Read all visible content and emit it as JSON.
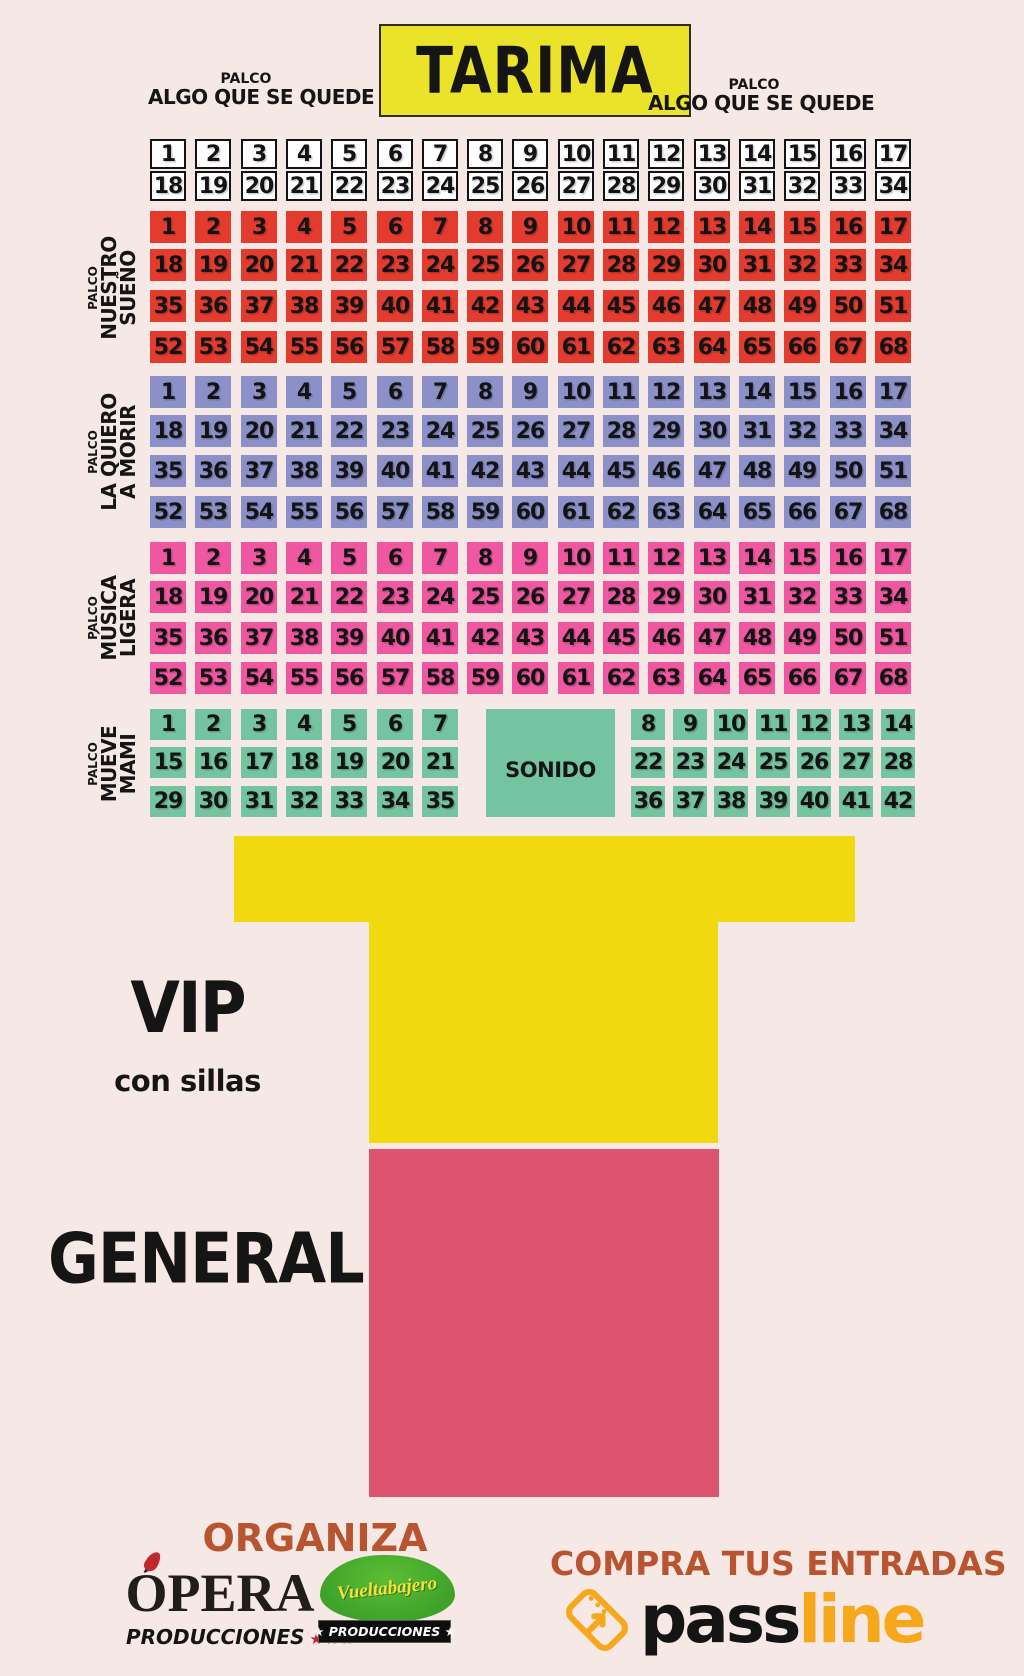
{
  "colors": {
    "background": "#f6e8e4",
    "stage_yellow": "#ebe32a",
    "seat_red": "#e33b2e",
    "seat_purple": "#8b90c8",
    "seat_pink": "#ef57a0",
    "seat_green": "#74c4a1",
    "vip_yellow": "#f0d90e",
    "general_pink": "#dd5470",
    "accent_orange": "#b95430",
    "passline_yellow": "#f6a71b",
    "star_red": "#c1272d",
    "vb_green": "#3fa32a",
    "vb_yellow": "#f3e13c"
  },
  "stage": {
    "label": "TARIMA"
  },
  "top_palco": {
    "left": {
      "small": "PALCO",
      "name": "ALGO QUE SE QUEDE"
    },
    "right": {
      "small": "PALCO",
      "name": "ALGO QUE SE QUEDE"
    }
  },
  "sections": [
    {
      "id": "algo-que-se-quede",
      "style": "white",
      "side_label": null,
      "rows": [
        [
          1,
          2,
          3,
          4,
          5,
          6,
          7,
          8,
          9,
          10,
          11,
          12,
          13,
          14,
          15,
          16,
          17
        ],
        [
          18,
          19,
          20,
          21,
          22,
          23,
          24,
          25,
          26,
          27,
          28,
          29,
          30,
          31,
          32,
          33,
          34
        ]
      ]
    },
    {
      "id": "nuestro-sueno",
      "style": "red",
      "side_label": {
        "small": "PALCO",
        "lines": [
          "NUESTRO",
          "SUEÑO"
        ]
      },
      "rows": [
        [
          1,
          2,
          3,
          4,
          5,
          6,
          7,
          8,
          9,
          10,
          11,
          12,
          13,
          14,
          15,
          16,
          17
        ],
        [
          18,
          19,
          20,
          21,
          22,
          23,
          24,
          25,
          26,
          27,
          28,
          29,
          30,
          31,
          32,
          33,
          34
        ],
        [
          35,
          36,
          37,
          38,
          39,
          40,
          41,
          42,
          43,
          44,
          45,
          46,
          47,
          48,
          49,
          50,
          51
        ],
        [
          52,
          53,
          54,
          55,
          56,
          57,
          58,
          59,
          60,
          61,
          62,
          63,
          64,
          65,
          66,
          67,
          68
        ]
      ]
    },
    {
      "id": "la-quiero-a-morir",
      "style": "purple",
      "side_label": {
        "small": "PALCO",
        "lines": [
          "LA QUIERO",
          "A MORIR"
        ]
      },
      "rows": [
        [
          1,
          2,
          3,
          4,
          5,
          6,
          7,
          8,
          9,
          10,
          11,
          12,
          13,
          14,
          15,
          16,
          17
        ],
        [
          18,
          19,
          20,
          21,
          22,
          23,
          24,
          25,
          26,
          27,
          28,
          29,
          30,
          31,
          32,
          33,
          34
        ],
        [
          35,
          36,
          37,
          38,
          39,
          40,
          41,
          42,
          43,
          44,
          45,
          46,
          47,
          48,
          49,
          50,
          51
        ],
        [
          52,
          53,
          54,
          55,
          56,
          57,
          58,
          59,
          60,
          61,
          62,
          63,
          64,
          65,
          66,
          67,
          68
        ]
      ]
    },
    {
      "id": "musica-ligera",
      "style": "pink",
      "side_label": {
        "small": "PALCO",
        "lines": [
          "MÚSICA",
          "LIGERA"
        ]
      },
      "rows": [
        [
          1,
          2,
          3,
          4,
          5,
          6,
          7,
          8,
          9,
          10,
          11,
          12,
          13,
          14,
          15,
          16,
          17
        ],
        [
          18,
          19,
          20,
          21,
          22,
          23,
          24,
          25,
          26,
          27,
          28,
          29,
          30,
          31,
          32,
          33,
          34
        ],
        [
          35,
          36,
          37,
          38,
          39,
          40,
          41,
          42,
          43,
          44,
          45,
          46,
          47,
          48,
          49,
          50,
          51
        ],
        [
          52,
          53,
          54,
          55,
          56,
          57,
          58,
          59,
          60,
          61,
          62,
          63,
          64,
          65,
          66,
          67,
          68
        ]
      ]
    },
    {
      "id": "mueve-mami",
      "style": "green",
      "side_label": {
        "small": "PALCO",
        "lines": [
          "MUEVE",
          "MAMI"
        ]
      },
      "rows": [
        {
          "left": [
            1,
            2,
            3,
            4,
            5,
            6,
            7
          ],
          "right": [
            8,
            9,
            10,
            11,
            12,
            13,
            14
          ]
        },
        {
          "left": [
            15,
            16,
            17,
            18,
            19,
            20,
            21
          ],
          "right": [
            22,
            23,
            24,
            25,
            26,
            27,
            28
          ]
        },
        {
          "left": [
            29,
            30,
            31,
            32,
            33,
            34,
            35
          ],
          "right": [
            36,
            37,
            38,
            39,
            40,
            41,
            42
          ]
        }
      ]
    }
  ],
  "sonido": {
    "label": "SONIDO"
  },
  "vip": {
    "title": "VIP",
    "subtitle": "con sillas"
  },
  "general": {
    "title": "GENERAL"
  },
  "footer": {
    "organiza": "ORGANIZA",
    "opera": {
      "name": "ÓPERA",
      "sub": "PRODUCCIONES",
      "stars": "★★★"
    },
    "vueltabajero": {
      "name": "Vueltabajero",
      "bar": "★ PRODUCCIONES ★"
    },
    "compra": "COMPRA TUS ENTRADAS",
    "passline": {
      "part1": "pass",
      "part2": "line"
    }
  }
}
